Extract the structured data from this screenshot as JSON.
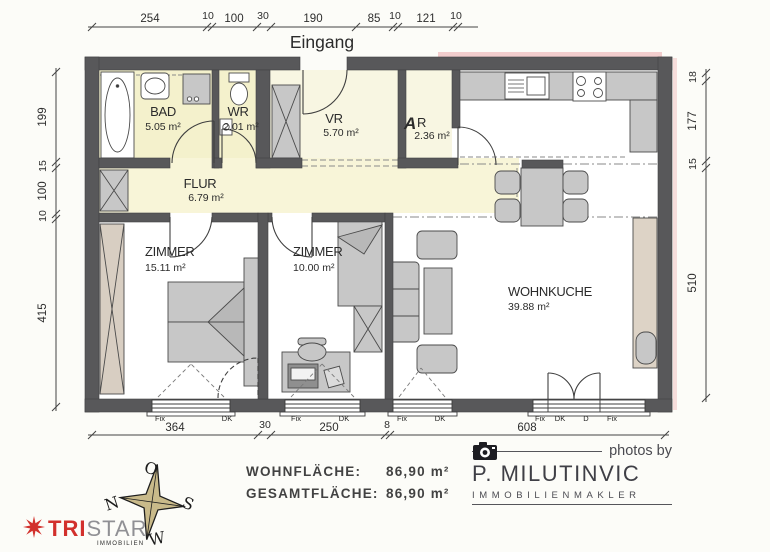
{
  "plan": {
    "entrance_label": "Eingang",
    "rooms": {
      "bad": {
        "name": "BAD",
        "area": "5.05 m²"
      },
      "wr": {
        "name": "WR",
        "area": "2.01 m²"
      },
      "vr": {
        "name": "VR",
        "area": "5.70 m²"
      },
      "ar": {
        "prefix": "A",
        "rest": "R",
        "area": "2.36 m²"
      },
      "flur": {
        "name": "FLUR",
        "area": "6.79 m²"
      },
      "zimmer1": {
        "name": "ZIMMER",
        "area": "15.11 m²"
      },
      "zimmer2": {
        "name": "ZIMMER",
        "area": "10.00 m²"
      },
      "wohnkueche": {
        "name": "WOHNKUCHE",
        "area": "39.88 m²"
      }
    },
    "dims": {
      "top": [
        "254",
        "10",
        "100",
        "30",
        "190",
        "85",
        "10",
        "121",
        "10"
      ],
      "left": [
        "199",
        "15",
        "100",
        "10",
        "415"
      ],
      "right": [
        "18",
        "177",
        "15",
        "510"
      ],
      "bottom": [
        "364",
        "30",
        "250",
        "8",
        "608"
      ]
    },
    "windows": {
      "w1": [
        "Fix",
        "DK"
      ],
      "w2": [
        "Fix",
        "DK"
      ],
      "w3": [
        "Fix",
        "DK"
      ],
      "w4": [
        "Fix",
        "DK",
        "D",
        "Fix"
      ]
    },
    "compass": {
      "top": "O",
      "right": "S",
      "bottom": "W",
      "left": "N"
    }
  },
  "footer": {
    "living_area_label": "WOHNFLÄCHE:",
    "living_area_value": "86,90 m²",
    "total_area_label": "GESAMTFLÄCHE:",
    "total_area_value": "86,90 m²"
  },
  "branding": {
    "photos_by": "photos by",
    "agent_name_left": "P. MILUTIN",
    "agent_name_right": "VIC",
    "agent_subtitle": "IMMOBILIENMAKLER",
    "tristar_bold": "TRI",
    "tristar_light": "STAR",
    "tristar_subtitle": "IMMOBILIEN"
  },
  "colors": {
    "wall": "#58585a",
    "room_yellow": "#f4f1cc",
    "hall_yellow": "#f8f5d8",
    "entrance_red": "#e01a1a",
    "annotation_blue": "#2b3d9b",
    "compass_fill": "#c9ba8a",
    "brand_red": "#d2302c"
  }
}
